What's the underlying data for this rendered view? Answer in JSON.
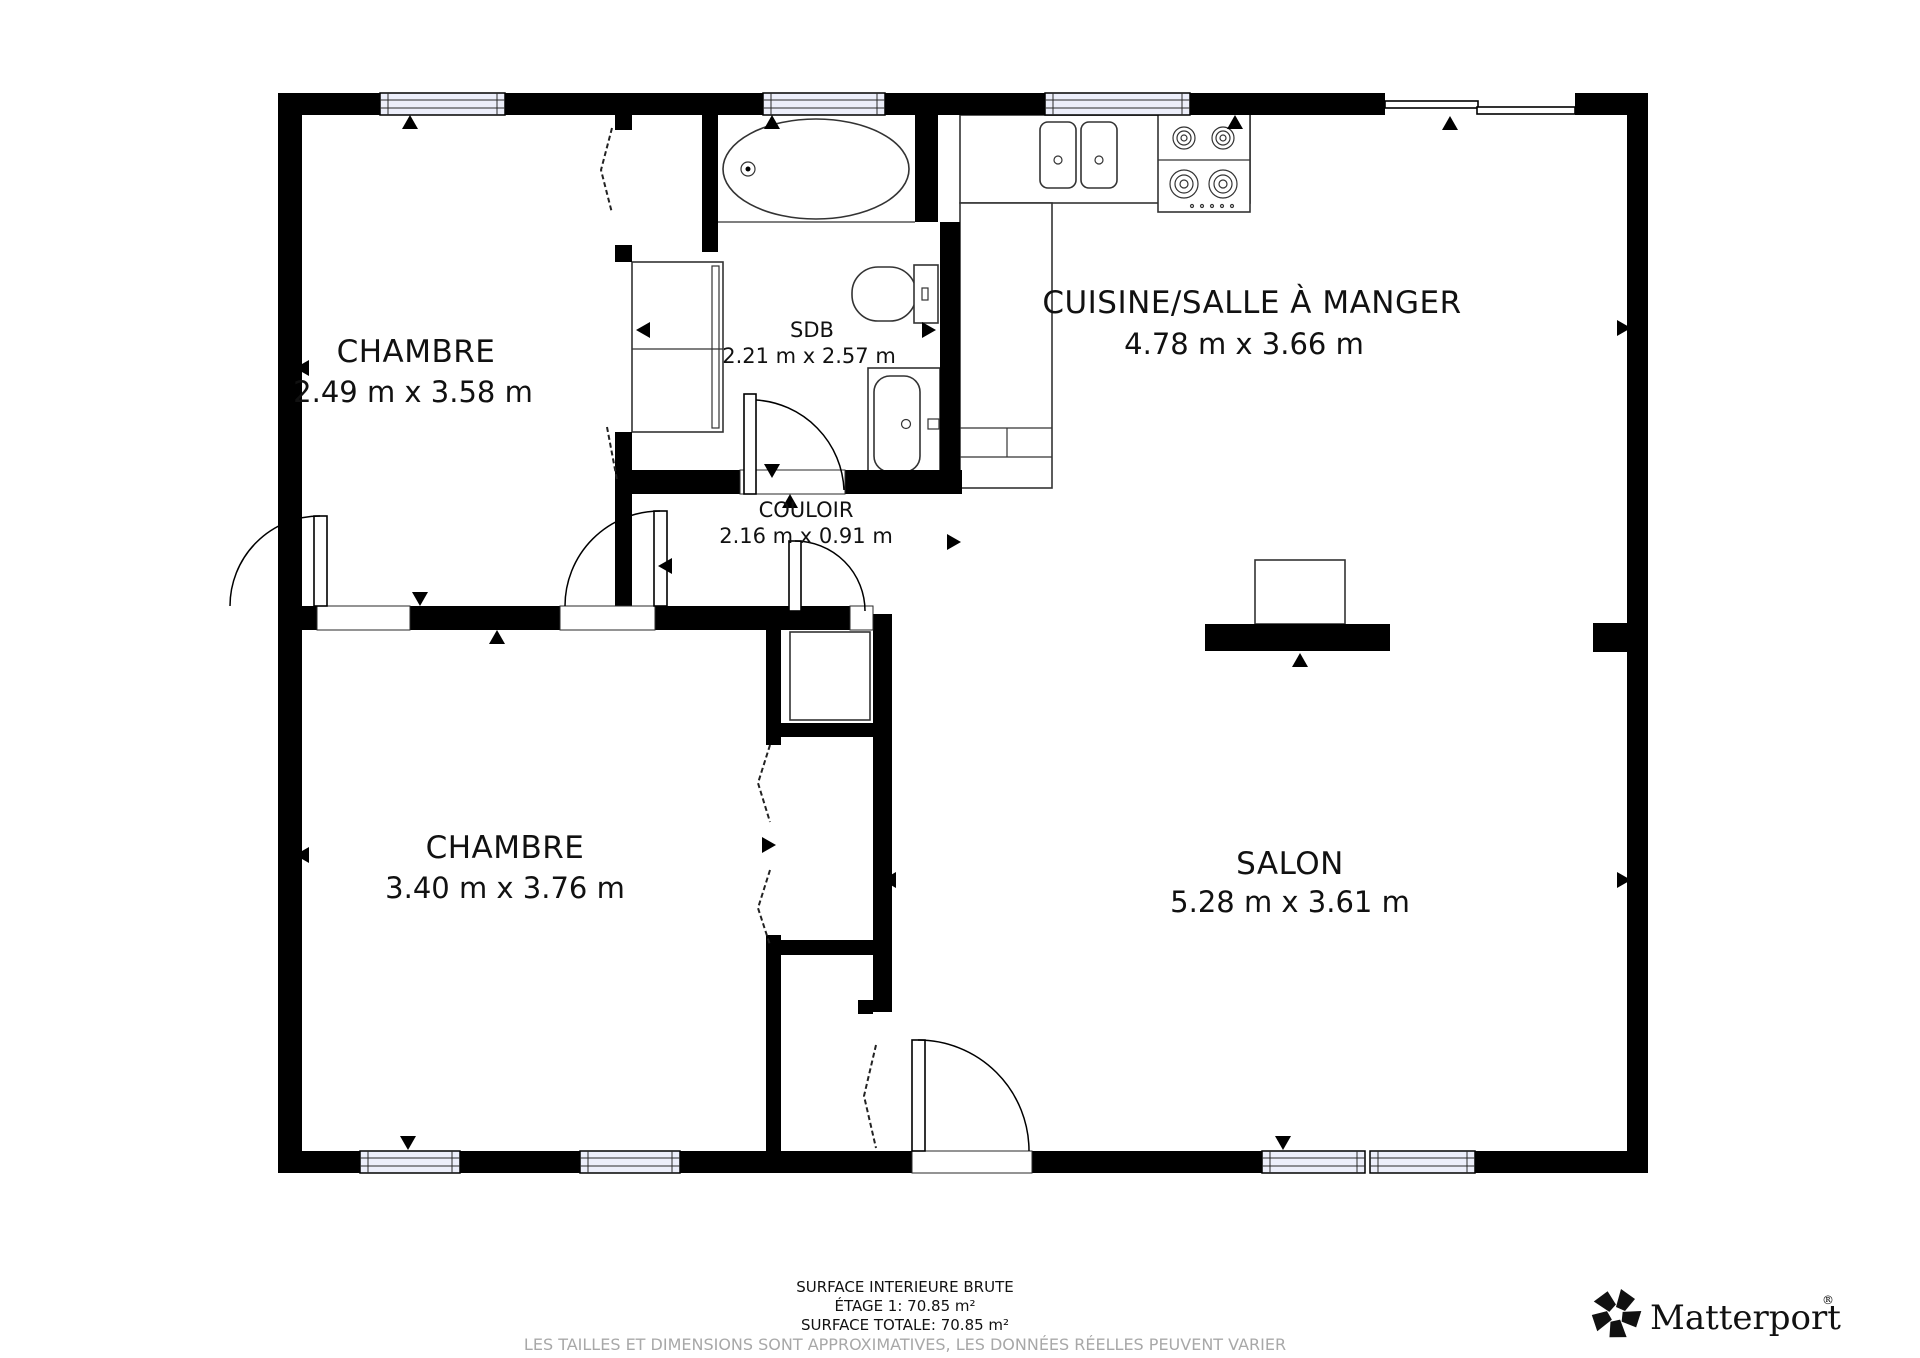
{
  "floorplan": {
    "type": "residential-floor-plan",
    "wall_color": "#000000",
    "background_color": "#ffffff",
    "window_fill": "#eceefa",
    "rooms": [
      {
        "name": "CHAMBRE",
        "dims": "2.49 m x 3.58 m"
      },
      {
        "name": "SDB",
        "dims": "2.21 m x 2.57 m"
      },
      {
        "name": "CUISINE/SALLE À MANGER",
        "dims": "4.78 m x 3.66 m"
      },
      {
        "name": "COULOIR",
        "dims": "2.16 m x 0.91 m"
      },
      {
        "name": "CHAMBRE",
        "dims": "3.40 m x 3.76 m"
      },
      {
        "name": "SALON",
        "dims": "5.28 m x 3.61 m"
      }
    ],
    "fixtures": [
      "bathtub",
      "toilet",
      "bathroom-sink",
      "kitchen-double-sink",
      "stove-4-burners",
      "kitchen-counter",
      "wardrobe",
      "closets"
    ]
  },
  "footer": {
    "line1": "SURFACE INTERIEURE BRUTE",
    "line2": "ÉTAGE 1: 70.85 m²",
    "line3": "SURFACE TOTALE: 70.85 m²",
    "disclaimer": "LES TAILLES ET DIMENSIONS SONT APPROXIMATIVES, LES DONNÉES RÉELLES PEUVENT VARIER"
  },
  "branding": {
    "logo_text": "Matterport",
    "registered_mark": "®"
  }
}
